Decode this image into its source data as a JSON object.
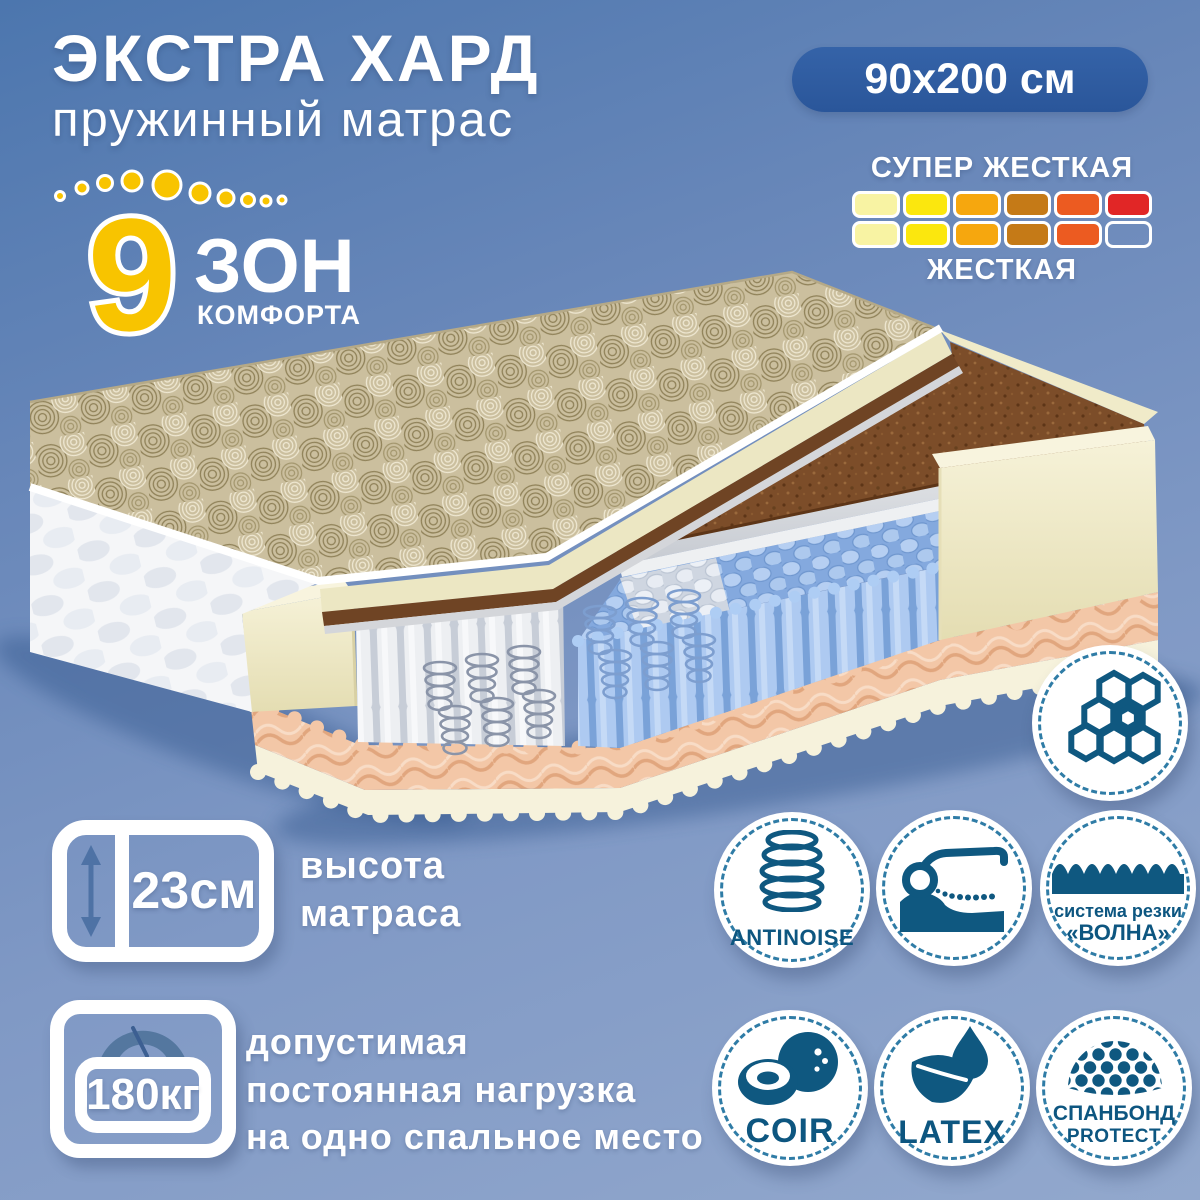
{
  "colors": {
    "background_top": "#4c76ae",
    "background_bottom": "#92a8cd",
    "pill_bg": "#2d5a9f",
    "accent_icon_blue": "#0f5880",
    "zone_yellow": "#f8c400",
    "slate_blue": "#4e72a5",
    "coir_brown": "#7c4d29",
    "spring_blue": "#9cbfec",
    "foam_cream": "#eee9c6",
    "peach_foam": "#f3c7a7"
  },
  "title": {
    "main": "ЭКСТРА ХАРД",
    "sub": "пружинный матрас"
  },
  "size_pill": {
    "text": "90x200 см"
  },
  "firmness": {
    "top": "СУПЕР ЖЕСТКАЯ",
    "bottom": "ЖЕСТКАЯ",
    "cols": 6,
    "top_filled": 6,
    "bottom_filled": 5,
    "colors": [
      "#f8f3a3",
      "#fbe70e",
      "#f6a70e",
      "#c57a17",
      "#ec5b21",
      "#e12626"
    ]
  },
  "zones": {
    "number": "9",
    "zon": "ЗОН",
    "komfort": "КОМФОРТА"
  },
  "height": {
    "value": "23см",
    "l1": "высота",
    "l2": "матраса"
  },
  "load": {
    "value": "180кг",
    "l1": "допустимая",
    "l2": "постоянная нагрузка",
    "l3": "на одно спальное место"
  },
  "features": {
    "antinoise": "ANTINOISE",
    "wave1": "система резки",
    "wave2": "«ВОЛНА»",
    "coir": "COIR",
    "latex": "LATEX",
    "spun1": "СПАНБОНД",
    "spun2": "PROTECT"
  }
}
